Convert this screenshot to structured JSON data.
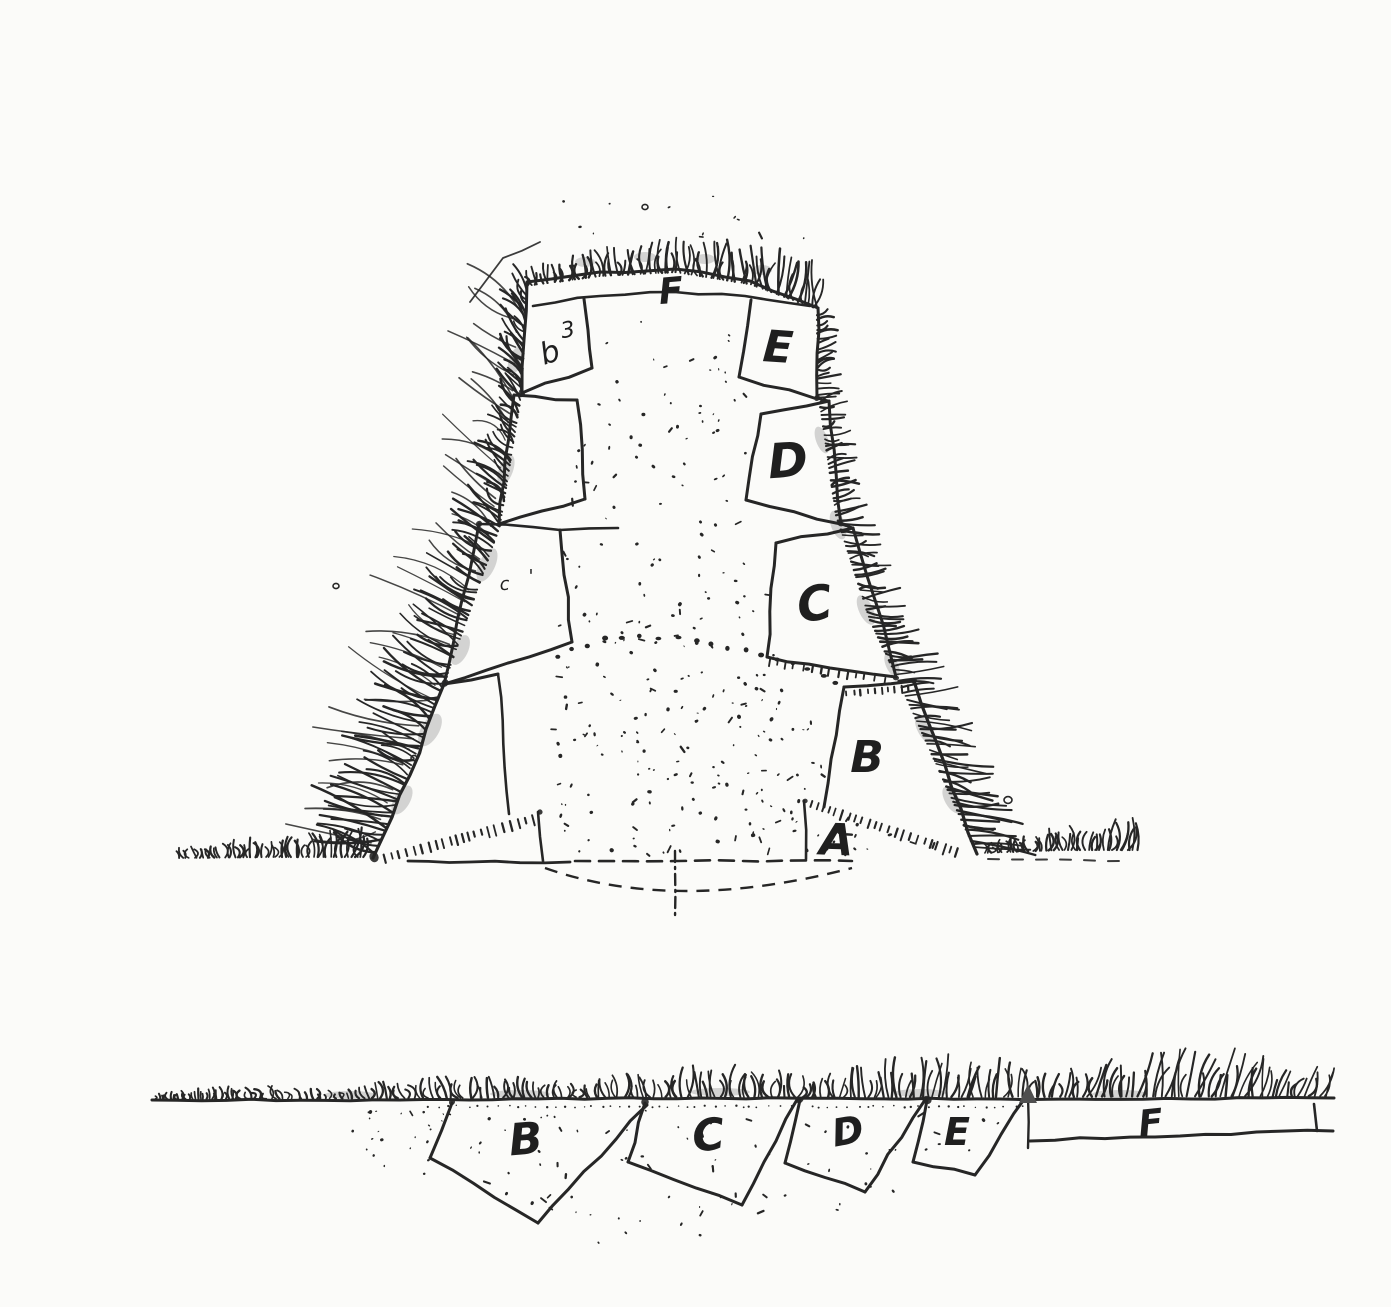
{
  "elevation_view": {
    "summit_label": "F",
    "cutting_labels": {
      "E": "E",
      "D": "D",
      "C": "C",
      "B": "B"
    },
    "base_label": "A",
    "left_panel_marks": {
      "mark_3": "3",
      "mark_b": "b",
      "mark_c": "c",
      "mark_tick": "'"
    }
  },
  "section_view": {
    "cutting_labels": {
      "B": "B",
      "C": "C",
      "D": "D",
      "E": "E",
      "F": "F"
    }
  }
}
